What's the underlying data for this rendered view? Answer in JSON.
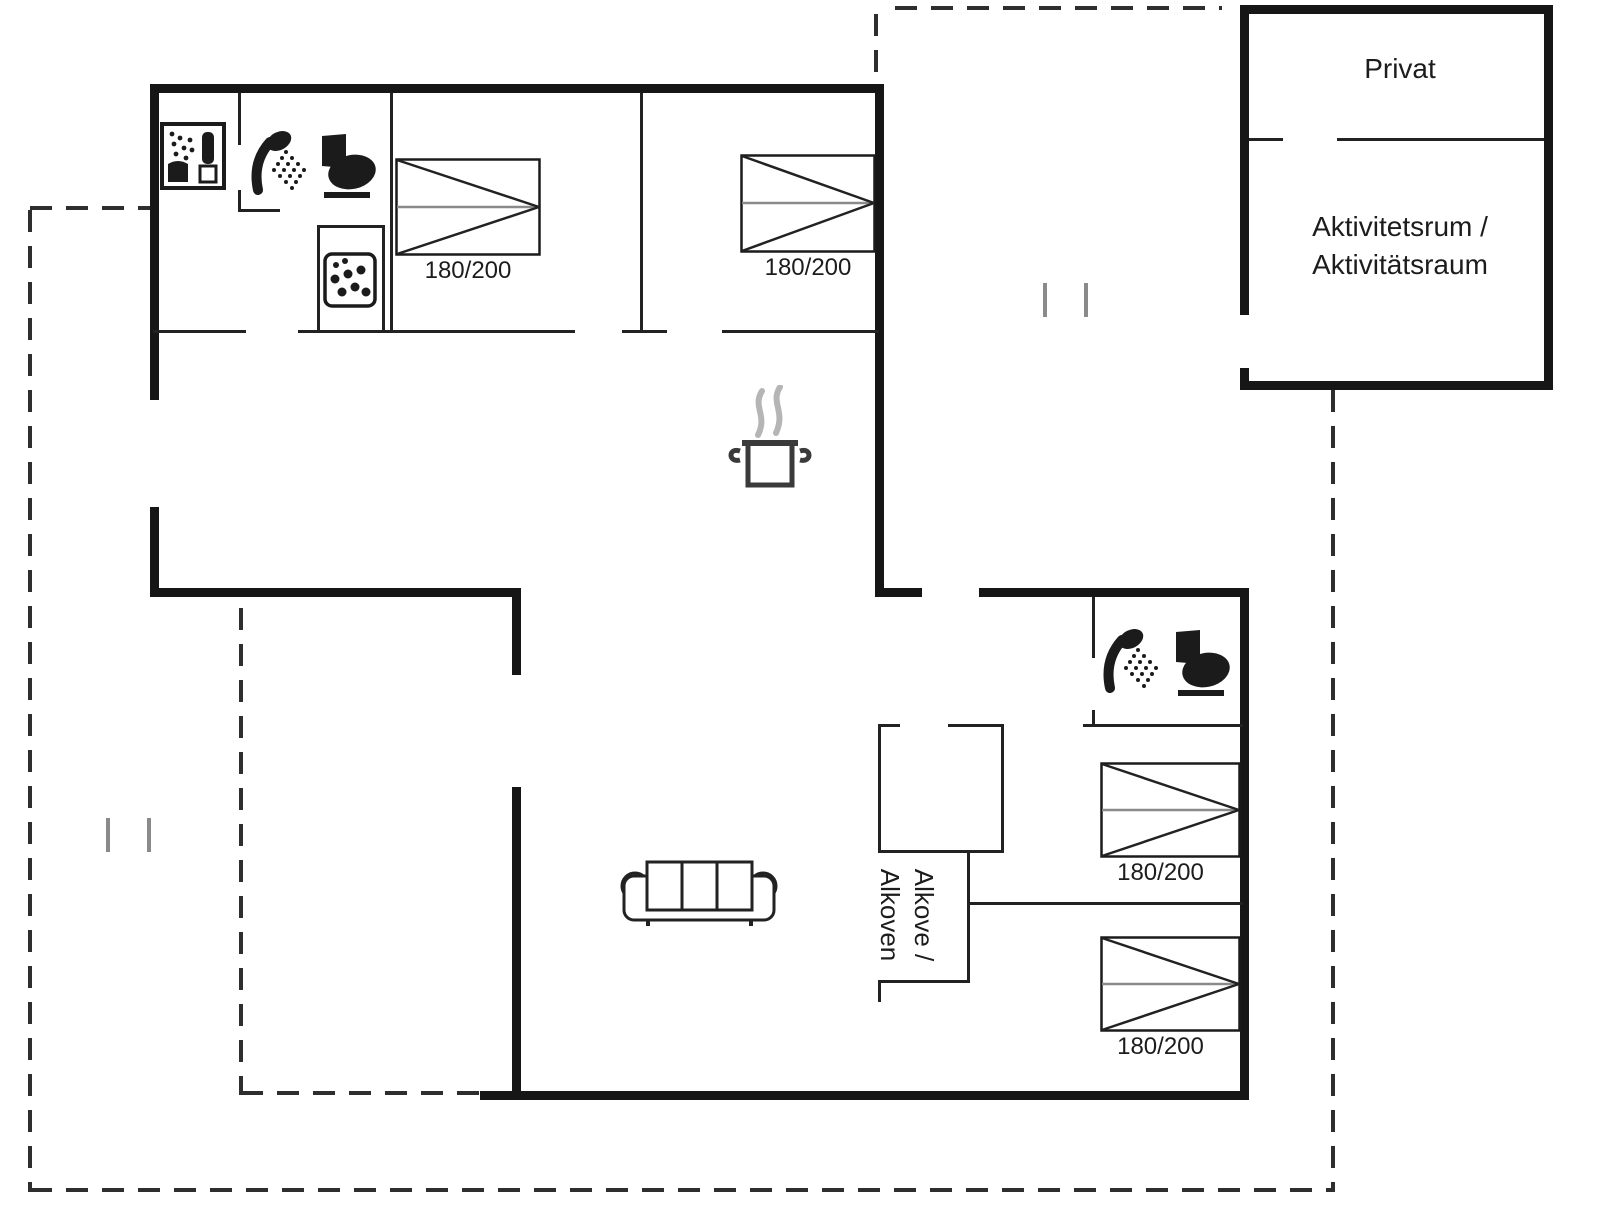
{
  "labels": {
    "privat": "Privat",
    "activity_room_line1": "Aktivitetsrum /",
    "activity_room_line2": "Aktivitätsraum",
    "alcove_line1": "Alkove /",
    "alcove_line2": "Alkoven"
  },
  "beds": [
    {
      "id": "bed-top-left",
      "label": "180/200"
    },
    {
      "id": "bed-top-middle",
      "label": "180/200"
    },
    {
      "id": "bed-right-upper",
      "label": "180/200"
    },
    {
      "id": "bed-right-lower",
      "label": "180/200"
    }
  ],
  "icons": [
    "washing-machine-icon",
    "shower-icon",
    "toilet-icon",
    "stove-hob-icon",
    "cooking-pot-icon",
    "sofa-icon",
    "shower-icon",
    "toilet-icon"
  ],
  "colors": {
    "wall": "#161616",
    "thin_wall": "#222222",
    "dashed_line": "#2e2e2e",
    "tick": "#8a8a8a",
    "steam": "#b5b5b5",
    "background": "#ffffff"
  }
}
